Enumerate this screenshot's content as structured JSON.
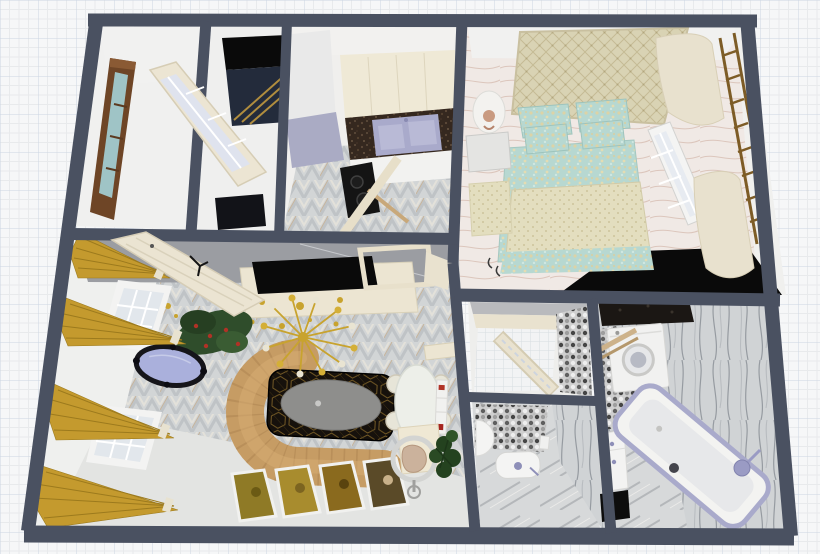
{
  "scene": {
    "view": "3d-floorplan-top-down-perspective",
    "canvas": "grid-paper",
    "rooms": [
      {
        "id": "entry-room",
        "objects": [
          "wood-framed-window",
          "glazed-door-open",
          "wall-art"
        ]
      },
      {
        "id": "hall-closet",
        "objects": [
          "wardrobe-gold-trim",
          "dark-bench"
        ]
      },
      {
        "id": "kitchen",
        "objects": [
          "tall-cabinet",
          "fridge-unit",
          "upper-cabinets",
          "stone-countertop",
          "double-sink",
          "base-cabinets",
          "cooktop",
          "broom",
          "open-door"
        ]
      },
      {
        "id": "bedroom",
        "objects": [
          "quilted-headboard-bed",
          "teal-pillows",
          "teal-duvet",
          "foot-blanket",
          "nightstand",
          "table-lamp",
          "bench",
          "window",
          "cream-curtains",
          "wall-ladder-rack",
          "black-rug"
        ]
      },
      {
        "id": "living-room",
        "objects": [
          "gold-curtains",
          "windows",
          "ornate-mirror",
          "christmas-tree",
          "leaning-glazed-door",
          "tv-console",
          "tv",
          "doorway",
          "sputnik-chandelier",
          "curved-sofa",
          "coffee-table",
          "floor-paintings",
          "dining-table",
          "dining-chairs",
          "ladder-shelf",
          "desk",
          "ring-chair",
          "potted-plant"
        ]
      },
      {
        "id": "wc",
        "objects": [
          "open-door",
          "white-tile-floor",
          "mosaic-wall"
        ]
      },
      {
        "id": "toilet-room",
        "objects": [
          "toilet",
          "corner-sink",
          "paper-holder",
          "mosaic-wall"
        ]
      },
      {
        "id": "bathroom",
        "objects": [
          "stone-counter",
          "washing-machine",
          "wood-shelf",
          "mosaic-floor",
          "vanity-sink",
          "bath-mat",
          "bathtub",
          "shower-head",
          "shower-control"
        ]
      }
    ]
  },
  "palette": {
    "wall": "#4a5161",
    "wall_face": "#f0f0ee",
    "gray_face": "#9b9da2",
    "floor_light": "#e3e4e2",
    "sofa": "#c69c64",
    "sofa_rib": "#a8814e",
    "curtain_gold": "#c49a2e",
    "curtain_edge": "#9c7a1d",
    "gold": "#c8a32e",
    "pearl": "#e9e4d2",
    "black": "#0a0a0a",
    "table_top": "#8e8e8c",
    "tree_green": "#2f4d2b",
    "berry_red": "#b03226",
    "cream": "#e9e2cf",
    "wood_brown": "#6e4526",
    "glass_teal": "#9fc4c6",
    "fixture_lavender": "#a9aacb",
    "bed_teal": "#b7d8d1",
    "bed_cream": "#d9d3b4",
    "counter_brown": "#35281f",
    "ladder_brown": "#7d5c26",
    "mirror_glass": "#aab0dc",
    "white": "#f4f4f3"
  }
}
